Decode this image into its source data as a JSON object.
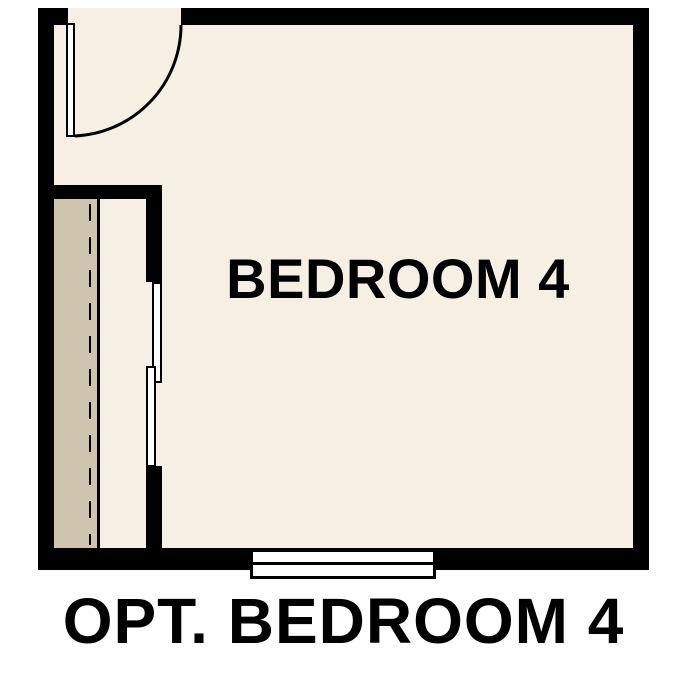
{
  "plan": {
    "room_label": "BEDROOM 4",
    "caption": "OPT. BEDROOM 4"
  },
  "colors": {
    "wall": "#000000",
    "floor": "#f6f0e4",
    "closet": "#cfc4ae",
    "background": "#ffffff",
    "text": "#000000",
    "fixture": "#ffffff"
  }
}
